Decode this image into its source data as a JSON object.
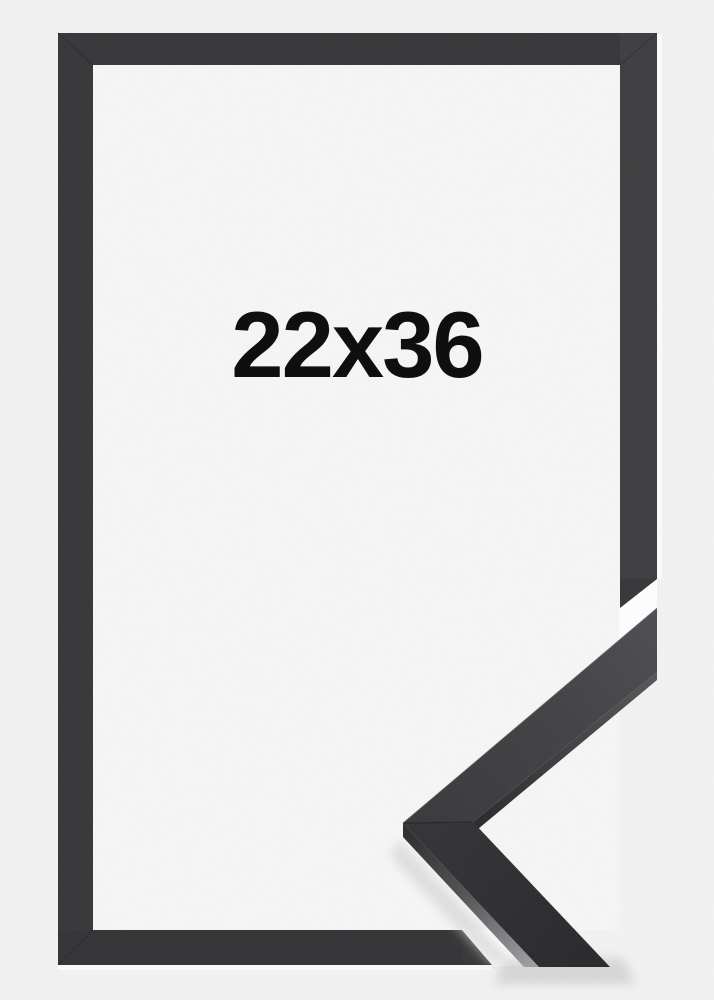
{
  "product": {
    "size_label": "22x36"
  },
  "colors": {
    "background": "#f0f0f1",
    "interior": "#f4f4f5",
    "frame": "#323234",
    "cut_gap": "#fcfcfd",
    "edge_highlight": "#f9f9fa",
    "label_text": "#0f0f10"
  }
}
